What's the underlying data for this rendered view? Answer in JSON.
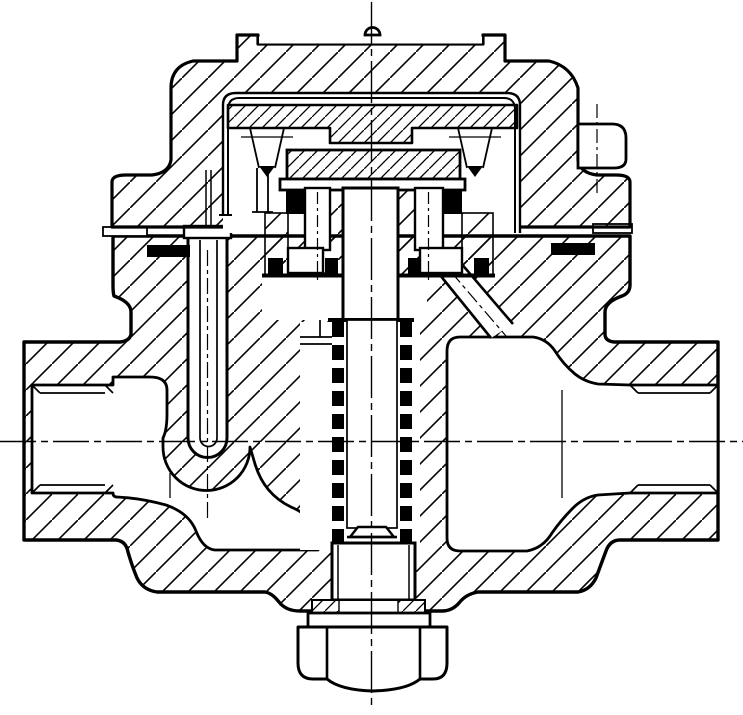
{
  "meta": {
    "description": "Sectional engineering drawing of a thermodynamic steam trap: hatched cap and body casting, inner cover liner, disc and seat assembly, inlet U-tube passage, perforated strainer screen column, threaded inlet and outlet ports, bottom hex strainer plug with gasket, and dash-dot centerlines.",
    "canvas": {
      "width": 743,
      "height": 715,
      "background": "#ffffff",
      "line_color": "#000000"
    }
  },
  "drawing": {
    "parts": [
      "cap",
      "cap-lid-plate",
      "cap-vent-bump",
      "side-lug",
      "cover-liner",
      "insert-plate",
      "disc",
      "disc-flange",
      "guide-posts",
      "seal-rings",
      "seat-blocks",
      "seat-gaskets",
      "stem-bolt",
      "inlet-u-tube",
      "strainer-screen",
      "valve-body",
      "inlet-port",
      "outlet-port",
      "outlet-passage",
      "hex-plug",
      "plug-gasket",
      "centerlines"
    ]
  }
}
